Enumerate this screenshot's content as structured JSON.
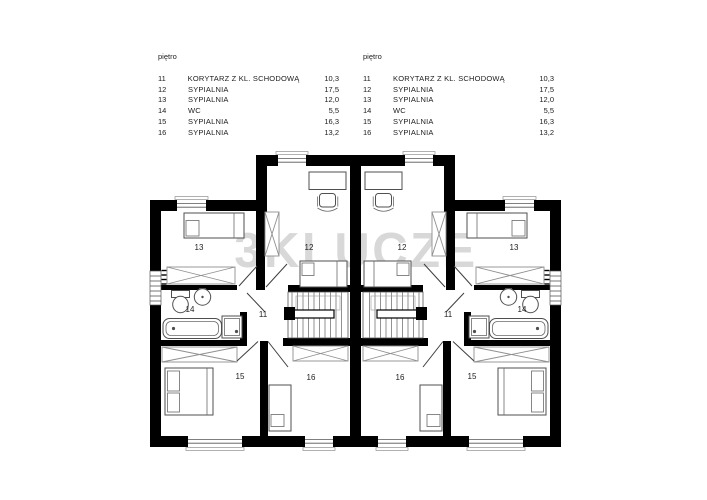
{
  "watermark": "3KLUCZE",
  "legend_left": {
    "floor_label": "piętro",
    "rows": [
      {
        "no": "11",
        "name": "KORYTARZ Z KL. SCHODOWĄ",
        "area": "10,3"
      },
      {
        "no": "12",
        "name": "SYPIALNIA",
        "area": "17,5"
      },
      {
        "no": "13",
        "name": "SYPIALNIA",
        "area": "12,0"
      },
      {
        "no": "14",
        "name": "WC",
        "area": "5,5"
      },
      {
        "no": "15",
        "name": "SYPIALNIA",
        "area": "16,3"
      },
      {
        "no": "16",
        "name": "SYPIALNIA",
        "area": "13,2"
      }
    ]
  },
  "legend_right": {
    "floor_label": "piętro",
    "rows": [
      {
        "no": "11",
        "name": "KORYTARZ Z KL. SCHODOWĄ",
        "area": "10,3"
      },
      {
        "no": "12",
        "name": "SYPIALNIA",
        "area": "17,5"
      },
      {
        "no": "13",
        "name": "SYPIALNIA",
        "area": "12,0"
      },
      {
        "no": "14",
        "name": "WC",
        "area": "5,5"
      },
      {
        "no": "15",
        "name": "SYPIALNIA",
        "area": "16,3"
      },
      {
        "no": "16",
        "name": "SYPIALNIA",
        "area": "13,2"
      }
    ]
  },
  "plan": {
    "colors": {
      "wall": "#000000",
      "watermark": "#d8d8d8"
    },
    "room_labels": [
      {
        "id": "left-13",
        "text": "13"
      },
      {
        "id": "left-12",
        "text": "12"
      },
      {
        "id": "right-12",
        "text": "12"
      },
      {
        "id": "right-13",
        "text": "13"
      },
      {
        "id": "left-14",
        "text": "14"
      },
      {
        "id": "right-14",
        "text": "14"
      },
      {
        "id": "left-11",
        "text": "11"
      },
      {
        "id": "right-11",
        "text": "11"
      },
      {
        "id": "left-15",
        "text": "15"
      },
      {
        "id": "left-16",
        "text": "16"
      },
      {
        "id": "right-16",
        "text": "16"
      },
      {
        "id": "right-15",
        "text": "15"
      }
    ]
  }
}
